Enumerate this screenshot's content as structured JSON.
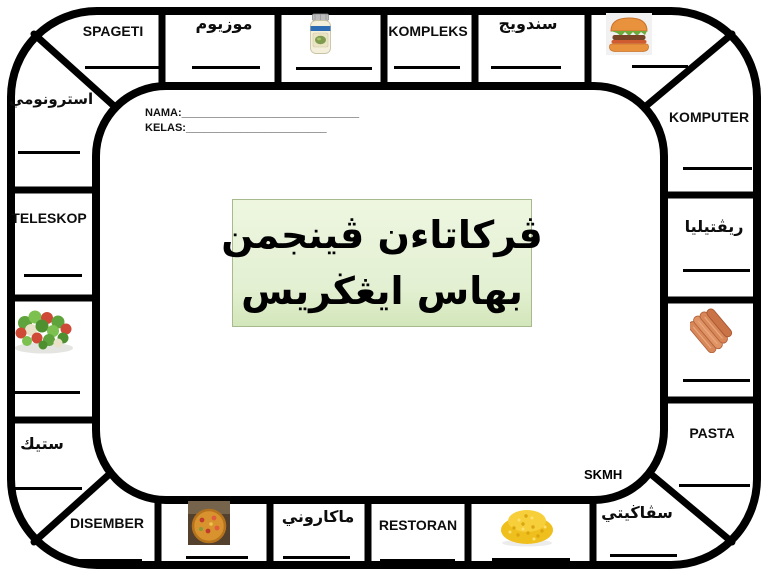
{
  "board_title": {
    "line1": "ڤرکاتاءن ڤينجمن",
    "line2": "بهاس ايڠڬريس",
    "background": "#e3f0d2",
    "border": "#a6ba8e"
  },
  "form": {
    "nama_label": "NAMA:",
    "nama_blank": "_____________________________",
    "kelas_label": "KELAS:",
    "kelas_blank": "_______________________"
  },
  "school_code": "SKMH",
  "cells": {
    "spageti": "SPAGETI",
    "muzium": "موزيوم",
    "kompleks": "KOMPLEKS",
    "sandwic": "سندويج",
    "komputer": "KOMPUTER",
    "reptilia": "ريڤتيليا",
    "pasta": "PASTA",
    "spageti_jawi": "سڤاڬيتي",
    "restoran": "RESTORAN",
    "makaroni": "ماكاروني",
    "disember": "DISEMBER",
    "stik": "ستيك",
    "teleskop": "TELESKOP",
    "astronomi": "استرونومي"
  },
  "icons": {
    "jar": "mayonnaise-jar",
    "burger": "hamburger",
    "salad": "salad-plate",
    "sausages": "sausages-bunch",
    "pizza": "pizza",
    "corn": "macaroni-heap"
  },
  "colors": {
    "line": "#000000",
    "background": "#ffffff"
  }
}
